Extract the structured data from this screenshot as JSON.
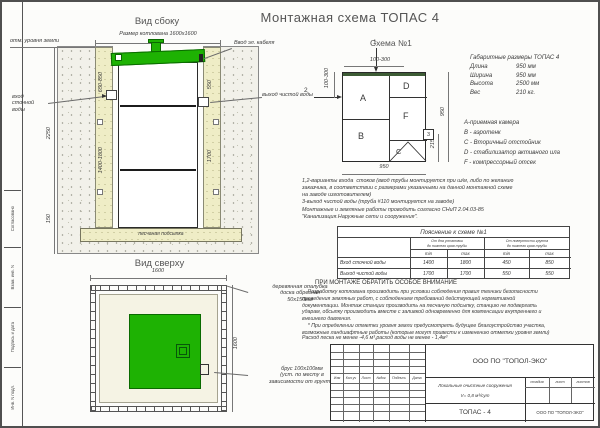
{
  "page_title": "Монтажная схема ТОПАС 4",
  "colors": {
    "tank_green": "#1eb203",
    "sand": "#efedc6",
    "ground_speckle": "#f2f1ea"
  },
  "stamp": {
    "approved": "Согласовано",
    "cells": [
      "Взам. инв. N",
      "Подпись и дата",
      "Инв. N подл."
    ]
  },
  "side_view": {
    "title": "Вид сбоку",
    "pit_size": "Размер котлована 1600х1600",
    "ground_level": "отм. уровня земли",
    "cable_entry": "Ввод эл. кабеля",
    "inlet": "вход\nсточной\nводы",
    "outlet": "выход чистой воды",
    "sand_bed": "песчаная подсыпка",
    "dim_depth": "2250",
    "dim_inlet_depth": "650-850",
    "dim_left_wall": "1400-1800",
    "dim_cable_depth": "550",
    "dim_right_wall": "1700",
    "dim_sand": "150"
  },
  "top_view": {
    "title": "Вид сверху",
    "dim_width": "1600",
    "dim_height": "1600",
    "formwork": "деревянная опалубка\nдоска обрезная\n50х150мм",
    "timber": "брус 100х100мм\n(уст. по месту в\nзависимости от грунта)"
  },
  "scheme": {
    "title": "Схема №1",
    "marker1": "1",
    "marker2": "2",
    "marker3": "3",
    "dim_top": "100-300",
    "dim_left": "100-300",
    "dim_bottom": "950",
    "dim_right": "950",
    "dim_outlet": "215",
    "section_a": "A",
    "section_b": "B",
    "section_c": "C",
    "section_d": "D",
    "section_f": "F"
  },
  "specs": {
    "title": "Габаритные размеры ТОПАС 4",
    "rows": [
      {
        "label": "Длина",
        "value": "950 мм"
      },
      {
        "label": "Ширина",
        "value": "950 мм"
      },
      {
        "label": "Высота",
        "value": "2500 мм"
      },
      {
        "label": "Вес",
        "value": "210 кг."
      }
    ]
  },
  "legend": {
    "items": [
      "А-приемная камера",
      "В - аэротенк",
      "С - Вторичный отстойник",
      "D - стабилизатор активного ила",
      "F - компрессорный отсек"
    ]
  },
  "notes": {
    "text": "1,2-варианты входа  стоков (ввод трубы монтируется при ш/м, либо по желанию\nзаказчика, в соответствии с размерами указанными на данной монтажной схеме\nна заводе изготовителем)\n3-выход чистой воды (труба #110 монтируется на заводе)\nМонтажные и земляные работы проводить согласно СНиП 2.04.03-85\n\"Канализация.Наружные сети и сооружения\"."
  },
  "explain_table": {
    "title": "Пояснение к схеме №1",
    "col1": "От дна установки\nдо нижнего края трубы",
    "col2": "От поверхности грунта\nдо нижнего края трубы",
    "subheaders": [
      "min",
      "max",
      "min",
      "max"
    ],
    "rows": [
      {
        "label": "Вход сточной воды",
        "v1": "1400",
        "v2": "1800",
        "v3": "450",
        "v4": "850"
      },
      {
        "label": "Выход чистой воды",
        "v1": "1700",
        "v2": "1700",
        "v3": "550",
        "v4": "550"
      }
    ]
  },
  "attention": {
    "heading": "ПРИ МОНТАЖЕ ОБРАТИТЬ ОСОБОЕ ВНИМАНИЕ",
    "body": "    Разработку котлована производить при условии соблюдения правил техники безопасности\nпроведения земляных работ, с соблюдением требований действующей нормативной\nдокументации. Монтаж станции производить на песчаную подсыпку, станцию не подвергать\nударам, обсыпку производить вместе с заливкой одновременно для компенсации внутреннего и\nвнешнего давления.\n    * При определении отметки уровня земли предусмотреть будущее благоустройство участка,\nвозможные ландшафтные работы (которые могут привести к изменению отметки уровня земли)",
    "footnote": "Расход песка не менее -4,6 м³,расход воды не менее - 1,4м³"
  },
  "title_block": {
    "header_cols": [
      "Изм",
      "Кол.уч",
      "Лист",
      "№док",
      "Подпись",
      "Дата"
    ],
    "company": "ООО ПО \"ТОПОЛ-ЭКО\"",
    "project_line1": "Локальные очистные сооружения",
    "project_line2": "V= 0,8 м³/сут",
    "stage": "стадия",
    "sheet": "лист",
    "sheets": "листов",
    "product": "ТОПАС - 4",
    "company2": "ООО ПО \"ТОПОЛ-ЭКО\""
  }
}
